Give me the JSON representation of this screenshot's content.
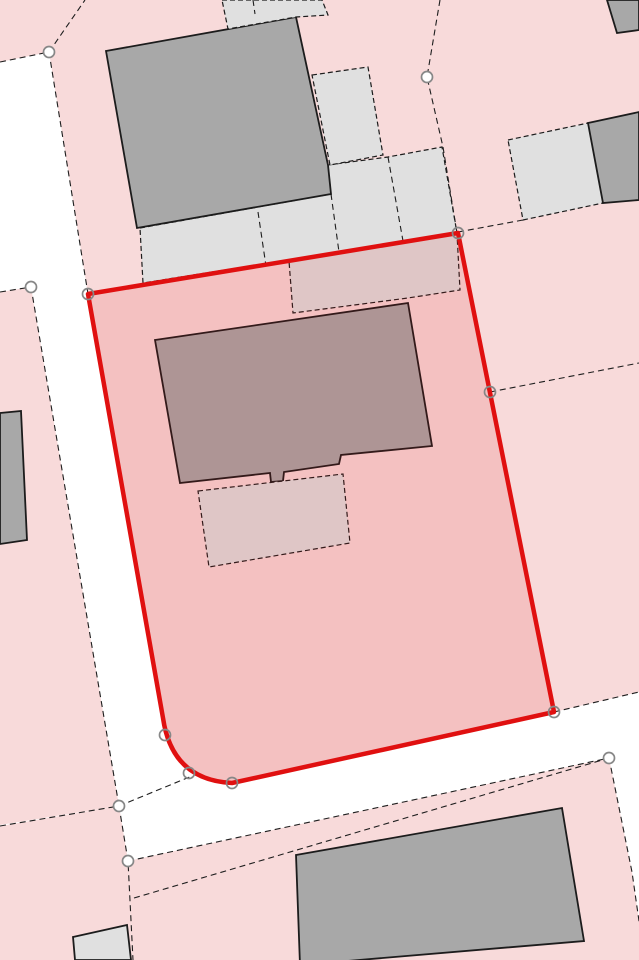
{
  "app": {
    "title": "Cadastral Parcel Map"
  },
  "map": {
    "width": 639,
    "height": 960,
    "colors": {
      "road": "#ffffff",
      "parcel": "#f8dada",
      "building_gray": "#a8a8a8",
      "structure_light": "#e0e0e0",
      "outline": "#1c1c1c",
      "line": "#1e1e1e"
    },
    "line_dash": "6 4",
    "structure_dash": "5 3",
    "parcels": [
      {
        "name": "parcel-top-left",
        "points": "0,0 85,0 49,52 0,62"
      },
      {
        "name": "parcel-main-block",
        "path": "M85,0 L639,0 L639,692 L554,712 L232,783 Q172,780 163,718 L88,294 L49,52 Z"
      },
      {
        "name": "parcel-left",
        "points": "0,292 31,287 119,806 0,825"
      },
      {
        "name": "parcel-bottom-left",
        "points": "0,826 119,806 128,861 133,960 0,960"
      },
      {
        "name": "parcel-bottom-right",
        "points": "128,861 609,758 632,872 641,935 641,960 133,960"
      }
    ],
    "structures": [
      {
        "name": "yard-apron-north",
        "fill": "structure_light",
        "dashed": true,
        "points": "140,228 331,194 328,165 388,157 442,147 457,233 143,283"
      },
      {
        "name": "building-north",
        "fill": "building_gray",
        "dashed": false,
        "points": "106,51 296,17 328,165 331,194 137,228"
      },
      {
        "name": "yard-band-top",
        "fill": "structure_light",
        "dashed": true,
        "points": "222,0 322,0 328,15 296,17 228,29"
      },
      {
        "name": "yard-upper-right",
        "fill": "structure_light",
        "dashed": true,
        "points": "312,75 368,67 383,155 330,165"
      },
      {
        "name": "yard-mid-right",
        "fill": "structure_light",
        "dashed": true,
        "points": "508,140 588,123 603,203 523,220"
      },
      {
        "name": "building-top-right-corner",
        "fill": "building_gray",
        "dashed": false,
        "points": "607,0 639,0 639,30 617,33"
      },
      {
        "name": "building-mid-right",
        "fill": "building_gray",
        "dashed": false,
        "points": "588,123 639,112 639,200 603,203"
      },
      {
        "name": "building-left-edge",
        "fill": "building_gray",
        "dashed": false,
        "points": "0,413 21,411 27,540 0,544"
      },
      {
        "name": "building-bottom-left-small",
        "fill": "structure_light",
        "dashed": false,
        "points": "73,937 127,925 131,960 75,960"
      },
      {
        "name": "building-south",
        "fill": "building_gray",
        "dashed": false,
        "points": "296,855 562,808 584,941 300,965"
      },
      {
        "name": "yard-strip-in-parcel",
        "fill": "structure_light",
        "dashed": true,
        "points": "289,261 457,234 460,290 408,298 293,313"
      },
      {
        "name": "building-main-house",
        "fill": "building_gray",
        "dashed": false,
        "points": "155,340 408,303 432,446 341,455 339,464 284,472 283,481 271,482 270,473 180,483"
      },
      {
        "name": "building-annex",
        "fill": "structure_light",
        "dashed": true,
        "points": "198,491 343,474 350,543 209,567"
      }
    ],
    "boundaries": [
      {
        "name": "boundary-topleft-west",
        "points": "0,62 49,52"
      },
      {
        "name": "boundary-topleft-north",
        "points": "49,52 85,0"
      },
      {
        "name": "boundary-road-east-upper",
        "points": "49,52 88,294"
      },
      {
        "name": "boundary-left-parcel-north",
        "points": "0,292 31,287"
      },
      {
        "name": "boundary-left-parcel-east",
        "points": "31,287 119,806"
      },
      {
        "name": "boundary-left-parcel-south",
        "points": "0,826 119,806"
      },
      {
        "name": "boundary-bottomleft-east",
        "points": "119,806 128,861 133,960"
      },
      {
        "name": "boundary-road-north-west",
        "points": "119,806 192,776"
      },
      {
        "name": "boundary-road-south",
        "points": "128,861 609,758"
      },
      {
        "name": "boundary-inner-south-strip",
        "points": "134,898 609,758"
      },
      {
        "name": "boundary-bottomright-east",
        "points": "609,758 632,872 641,935"
      },
      {
        "name": "boundary-road-north-east",
        "points": "554,712 639,692"
      },
      {
        "name": "boundary-right-parcel-split",
        "points": "490,392 639,363"
      },
      {
        "name": "boundary-northeast-parcel",
        "points": "440,0 427,77 443,147 457,233"
      },
      {
        "name": "boundary-corner-to-yard",
        "points": "458,232 523,220"
      },
      {
        "name": "divider-apron-1",
        "points": "258,212 266,266"
      },
      {
        "name": "divider-apron-2",
        "points": "331,194 339,252"
      },
      {
        "name": "divider-apron-3",
        "points": "388,157 403,241"
      },
      {
        "name": "divider-band-top",
        "points": "253,0 255,14"
      }
    ],
    "selection": {
      "path": "M88,294 L458,233 L554,712 L232,783 Q172,780 163,718 Z",
      "fill": "rgba(224,16,16,0.12)",
      "stroke": "#e01010",
      "stroke_width": 4.5
    },
    "marker": {
      "radius": 5.5,
      "stroke": "#878787",
      "stroke_width": 1.7
    },
    "markers": [
      {
        "x": 49,
        "y": 52,
        "filled": true
      },
      {
        "x": 31,
        "y": 287,
        "filled": true
      },
      {
        "x": 427,
        "y": 77,
        "filled": true
      },
      {
        "x": 88,
        "y": 294,
        "filled": false
      },
      {
        "x": 458,
        "y": 233,
        "filled": false
      },
      {
        "x": 490,
        "y": 392,
        "filled": false
      },
      {
        "x": 554,
        "y": 712,
        "filled": false
      },
      {
        "x": 609,
        "y": 758,
        "filled": true
      },
      {
        "x": 165,
        "y": 735,
        "filled": false
      },
      {
        "x": 189,
        "y": 773,
        "filled": false
      },
      {
        "x": 232,
        "y": 783,
        "filled": false
      },
      {
        "x": 119,
        "y": 806,
        "filled": true
      },
      {
        "x": 128,
        "y": 861,
        "filled": true
      }
    ]
  }
}
